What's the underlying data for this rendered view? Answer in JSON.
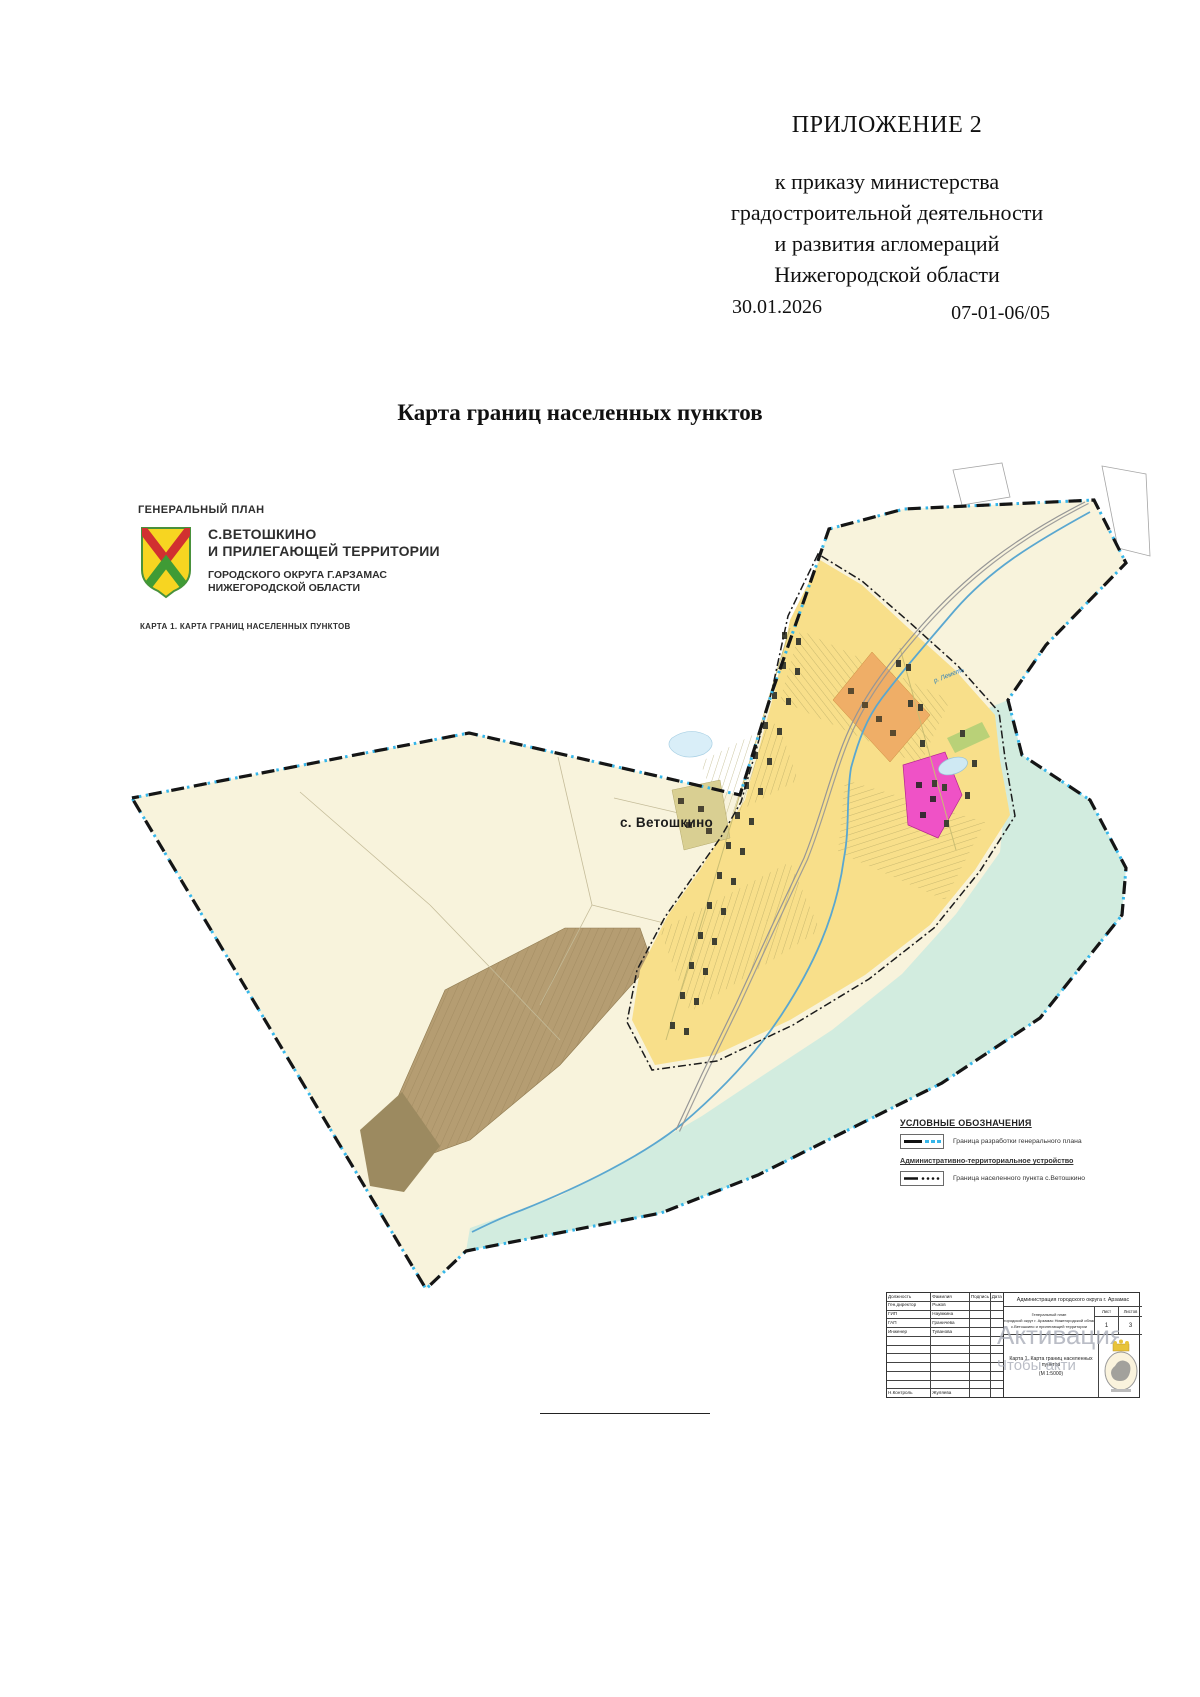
{
  "page": {
    "appendix_label": "ПРИЛОЖЕНИЕ 2",
    "order_reference": {
      "line1": "к приказу министерства",
      "line2": "градостроительной деятельности",
      "line3": "и развития агломераций",
      "line4": "Нижегородской области"
    },
    "order_date": "30.01.2026",
    "order_number": "07-01-06/05",
    "document_title": "Карта границ населенных пунктов"
  },
  "map": {
    "header": {
      "kicker": "ГЕНЕРАЛЬНЫЙ ПЛАН",
      "title_line1": "С.ВЕТОШКИНО",
      "title_line2": "И ПРИЛЕГАЮЩЕЙ ТЕРРИТОРИИ",
      "subtitle_line1": "ГОРОДСКОГО ОКРУГА Г.АРЗАМАС",
      "subtitle_line2": "НИЖЕГОРОДСКОЙ ОБЛАСТИ",
      "caption": "КАРТА 1. КАРТА ГРАНИЦ НАСЕЛЕННЫХ ПУНКТОВ"
    },
    "labels": {
      "settlement": "с. Ветошкино",
      "river": "р. Леметь"
    },
    "legend": {
      "heading": "УСЛОВНЫЕ ОБОЗНАЧЕНИЯ",
      "item1_label": "Граница разработки генерального плана",
      "subheading": "Административно-территориальное устройство",
      "item2_label": "Граница населенного пункта с.Ветошкино"
    },
    "title_block": {
      "col_position": "Должность",
      "col_surname": "Фамилия",
      "col_signature": "Подпись",
      "col_date": "Дата",
      "rows": [
        {
          "position": "Ген.директор",
          "surname": "Рыков"
        },
        {
          "position": "ГИП",
          "surname": "Наумкина"
        },
        {
          "position": "ГАП",
          "surname": "Граничева"
        },
        {
          "position": "Инженер",
          "surname": "Туванова"
        }
      ],
      "control_row": {
        "position": "Н.Контроль",
        "surname": "Жуляева"
      },
      "organization": "Администрация городского округа г. Арзамас",
      "project_line1": "Генеральный план",
      "project_line2": "городской округ г. Арзамас Нижегородской области",
      "project_line3": "с.Ветошкино и прилегающей территории",
      "sheet_label": "Лист",
      "sheet_value": "1",
      "sheets_label": "Листов",
      "sheets_value": "3",
      "map_title": "Карта 1. Карта границ населенных пунктов",
      "map_scale": "(М 1:5000)"
    },
    "watermark": {
      "line1": "Активация",
      "line2": "Чтобы акти"
    },
    "colors": {
      "territory": "#f8f3dc",
      "built_up": "#f8df8a",
      "floodplain": "#d2ecdf",
      "fields": "#b59d72",
      "industrial_strip": "#efae67",
      "special_zone": "#ef52c6",
      "water": "#cfe9f3",
      "river": "#5aa7d0",
      "plan_boundary_accent": "#35b6ea",
      "arms_gold": "#f7d521",
      "arms_red": "#d13030",
      "arms_green": "#3f9b35"
    }
  }
}
